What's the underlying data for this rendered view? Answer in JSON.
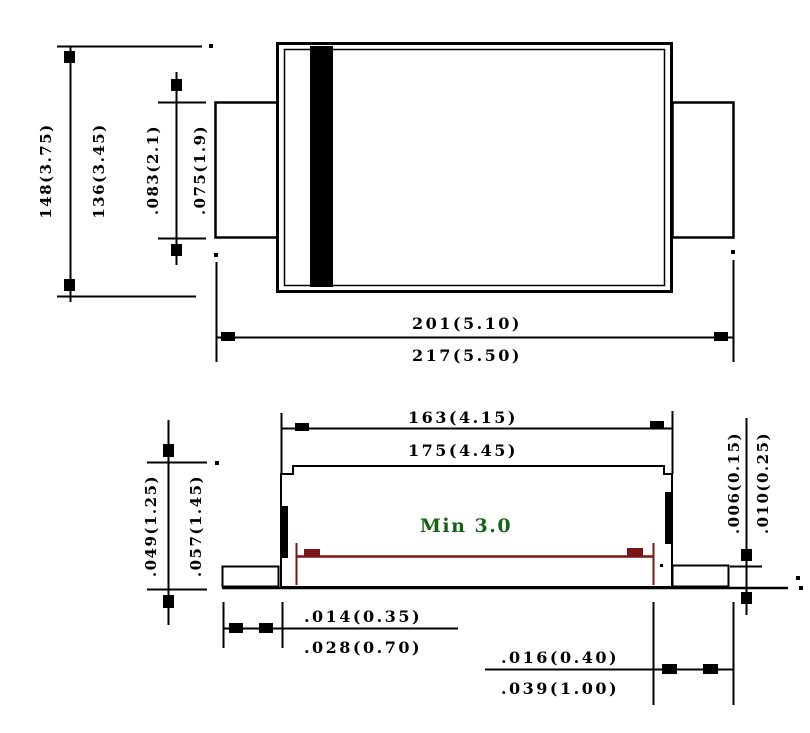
{
  "dims": {
    "top": {
      "height_max": "148(3.75)",
      "height_min": "136(3.45)",
      "terminal_width_max": ".083(2.1)",
      "terminal_width_min": ".075(1.9)",
      "body_length": "201(5.10)",
      "overall_length": "217(5.50)"
    },
    "side": {
      "body_top_min": "163(4.15)",
      "body_top_max": "175(4.45)",
      "height_min": ".049(1.25)",
      "height_max": ".057(1.45)",
      "standoff_min": ".006(0.15)",
      "standoff_max": ".010(0.25)",
      "foot_min": ".014(0.35)",
      "foot_max": ".028(0.70)",
      "terminal_min": ".016(0.40)",
      "terminal_max": ".039(1.00)",
      "solder_note": "Min 3.0"
    }
  },
  "colors": {
    "line": "#000000",
    "solder_dim": "#7a1517",
    "note_green": "#156315",
    "cathode_band": "#000000",
    "background": "#ffffff"
  }
}
